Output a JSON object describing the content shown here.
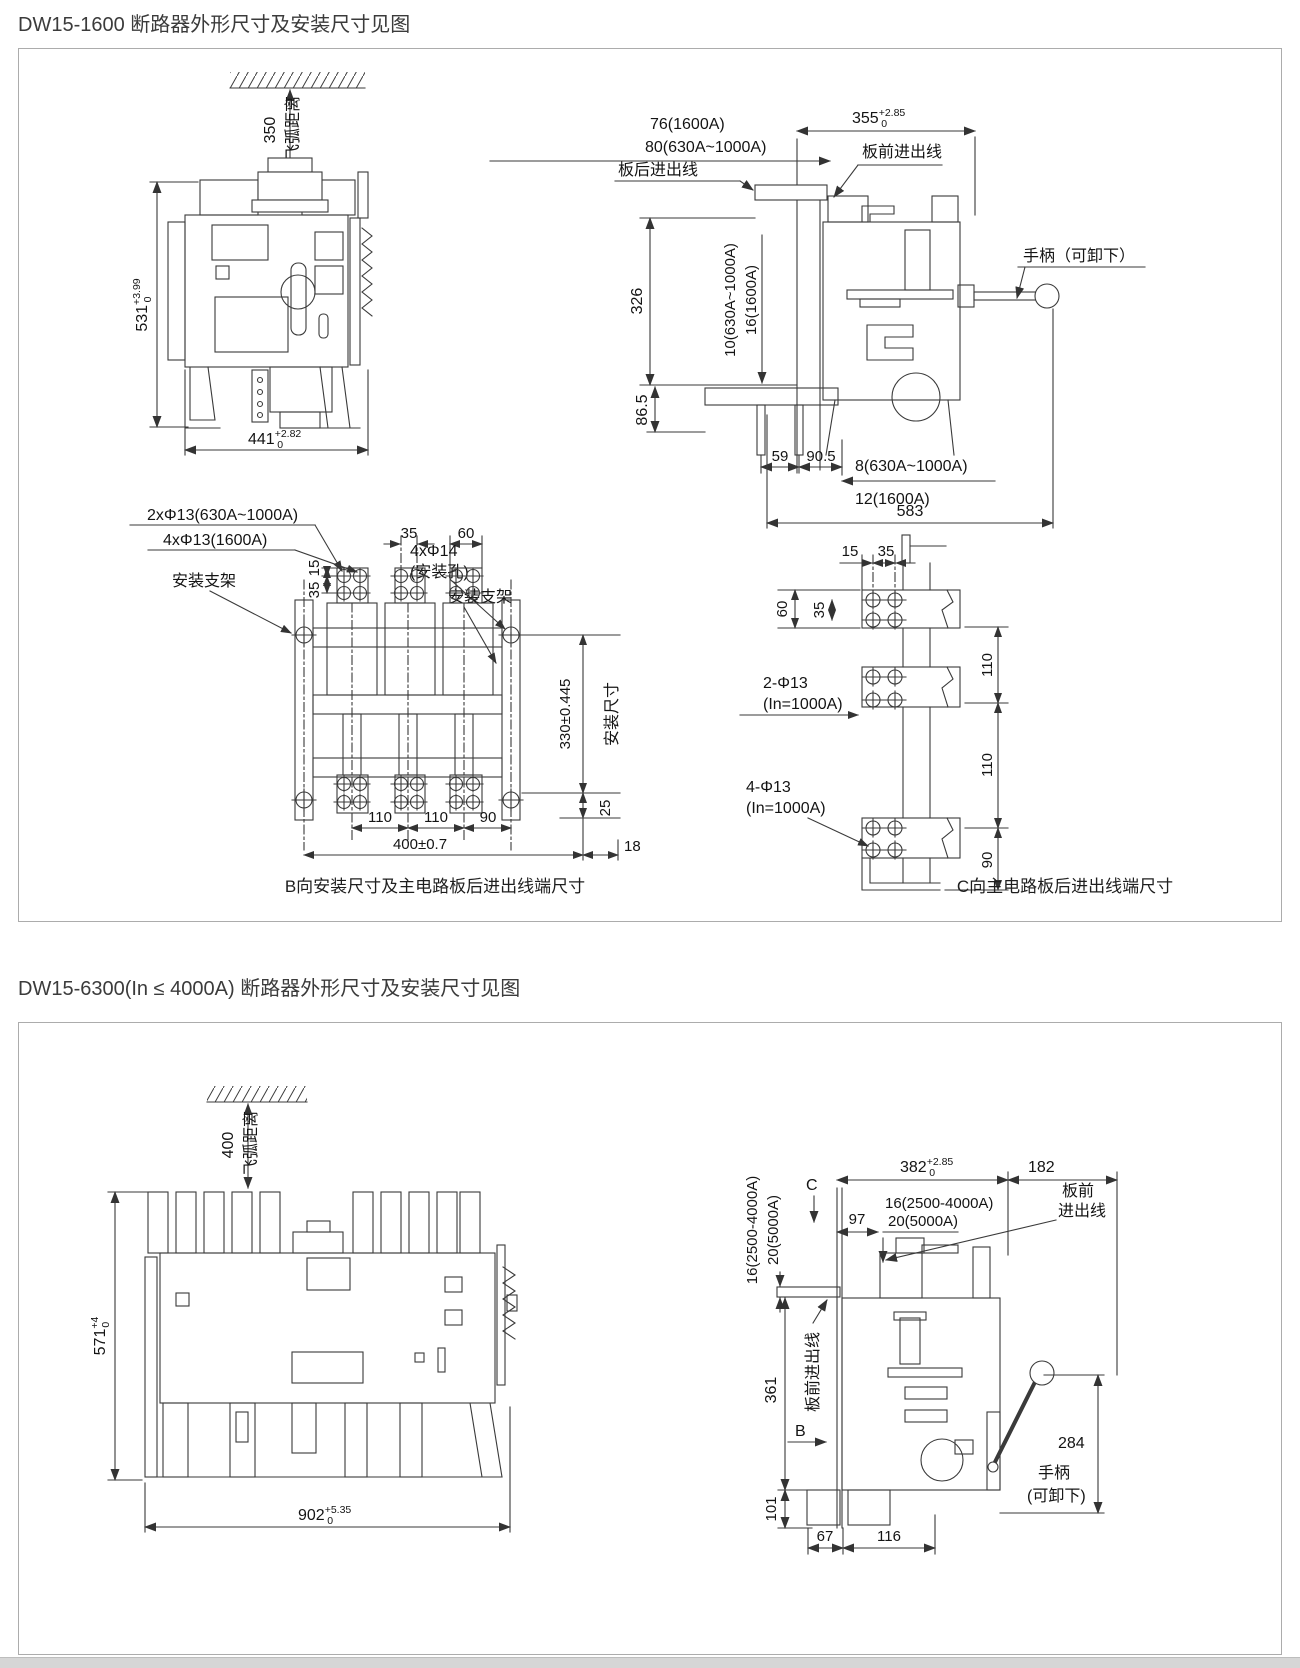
{
  "s1": {
    "title": "DW15-1600 断路器外形尺寸及安装尺寸见图",
    "d1": {
      "fly": "350",
      "fly2": "飞弧距离",
      "h": "531",
      "h_sup": "+3.99",
      "h_inf": "0",
      "w": "441",
      "w_sup": "+2.82",
      "w_inf": "0"
    },
    "d2": {
      "w": "355",
      "w_sup": "+2.85",
      "w_inf": "0",
      "d76": "76(1600A)",
      "d80": "80(630A~1000A)",
      "front": "板前进出线",
      "rear": "板后进出线",
      "handle": "手柄（可卸下）",
      "v326": "326",
      "t10": "10(630A~1000A)",
      "t16": "16(1600A)",
      "v865": "86.5",
      "d59": "59",
      "d905": "90.5",
      "d8": "8(630A~1000A)",
      "d12": "12(1600A)",
      "d583": "583"
    },
    "d3": {
      "h2": "2xΦ13(630A~1000A)",
      "h4": "4xΦ13(1600A)",
      "d35": "35",
      "d60": "60",
      "v15": "15",
      "v35": "35",
      "m14": "4xΦ14",
      "m14b": "(安装孔)",
      "bkl": "安装支架",
      "bkr": "安装支架",
      "v330": "330±0.445",
      "inst": "安装尺寸",
      "d110a": "110",
      "d110b": "110",
      "d90": "90",
      "d400": "400±0.7",
      "d18": "18",
      "d25": "25",
      "cap": "B向安装尺寸及主电路板后进出线端尺寸"
    },
    "d4": {
      "d15": "15",
      "d35": "35",
      "v60": "60",
      "v35": "35",
      "h2": "2-Φ13",
      "h2b": "(In=1000A)",
      "h4": "4-Φ13",
      "h4b": "(In=1000A)",
      "v110a": "110",
      "v110b": "110",
      "v90": "90",
      "cap": "C向主电路板后进出线端尺寸"
    }
  },
  "s2": {
    "title": "DW15-6300(In ≤ 4000A) 断路器外形尺寸及安装尺寸见图",
    "d5": {
      "fly": "400",
      "fly2": "飞弧距离",
      "h": "571",
      "h_sup": "+4",
      "h_inf": "0",
      "w": "902",
      "w_sup": "+5.35",
      "w_inf": "0"
    },
    "d6": {
      "w382": "382",
      "w382_sup": "+2.85",
      "w382_inf": "0",
      "w182": "182",
      "c": "C",
      "d97": "97",
      "t16": "16(2500-4000A)",
      "t20": "20(5000A)",
      "l16": "16(2500-4000A)",
      "l20": "20(5000A)",
      "front1": "板前",
      "front2": "进出线",
      "frontl": "板前进出线",
      "b": "B",
      "v361": "361",
      "v101": "101",
      "v284": "284",
      "hand1": "手柄",
      "hand2": "(可卸下)",
      "d67": "67",
      "d116": "116"
    }
  }
}
